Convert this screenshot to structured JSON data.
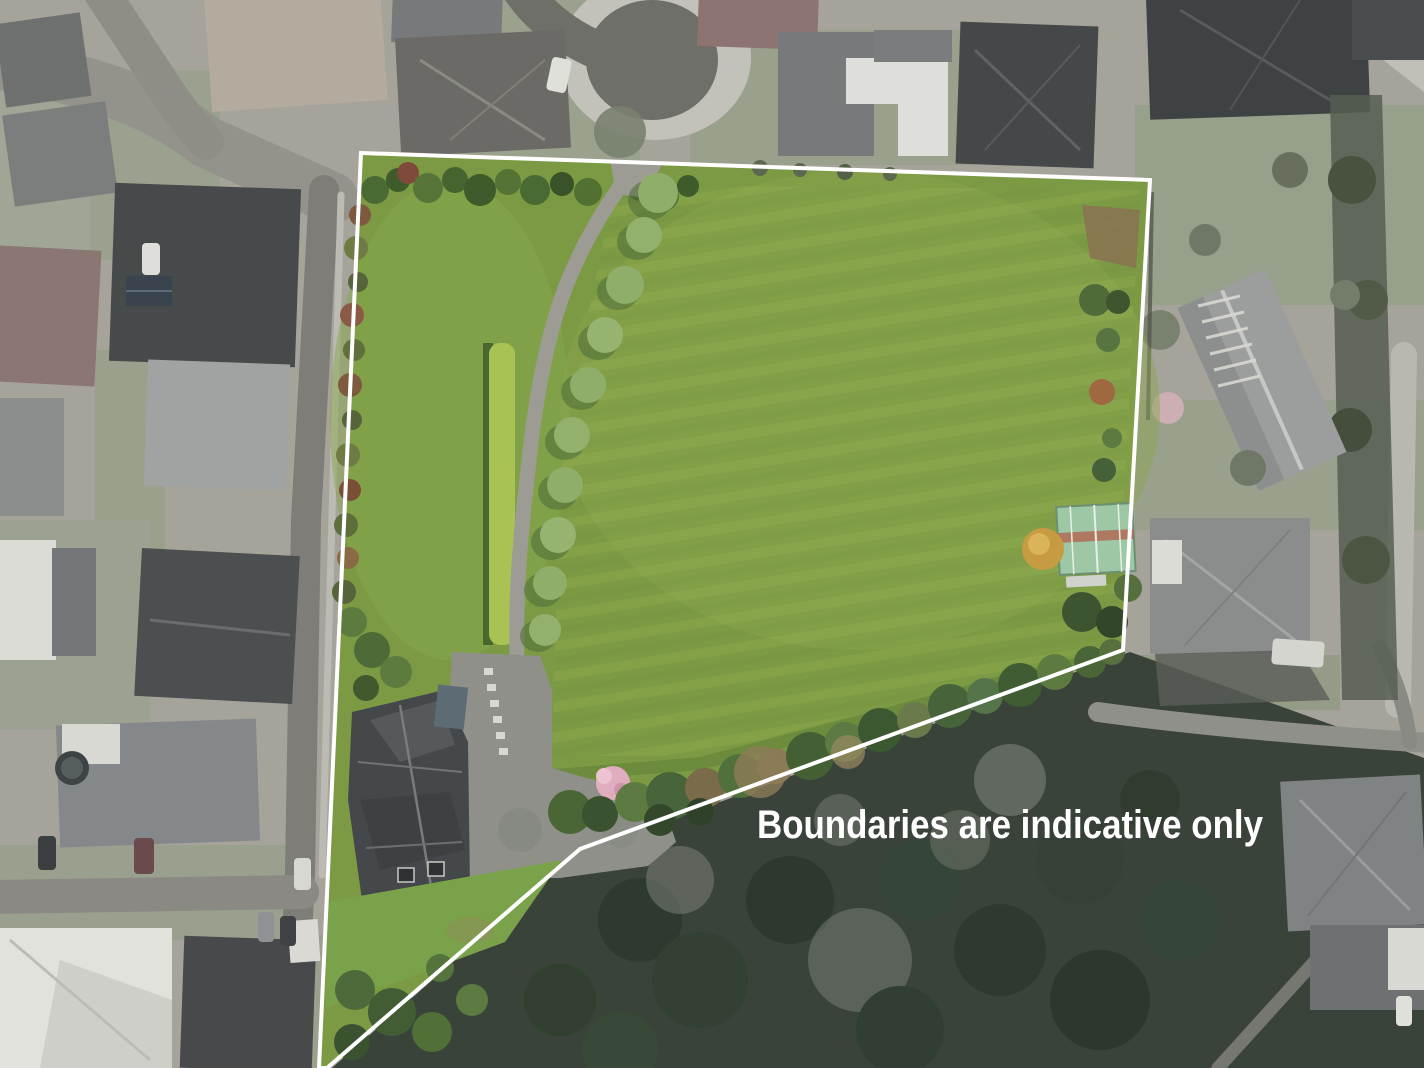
{
  "overlay": {
    "caption": "Boundaries are indicative only",
    "caption_color": "#ffffff"
  },
  "boundary": {
    "points": "361,153 1150,180 1123,650 580,849 327,1068 319,1068",
    "stroke_color": "#ffffff",
    "stroke_width": 4
  },
  "colors": {
    "field_green": "#7c9a44",
    "field_stripe": "#a3bd55",
    "surroundings_gray": "#a6a39b",
    "forest_dark": "#39433a",
    "hedge_green": "#a9c254",
    "driveway_gray": "#9c9c95",
    "roof_charcoal": "#45484a",
    "shed_mint": "#9ec7a6",
    "blossom_pink": "#dfadbe",
    "boundary_white": "#ffffff"
  }
}
